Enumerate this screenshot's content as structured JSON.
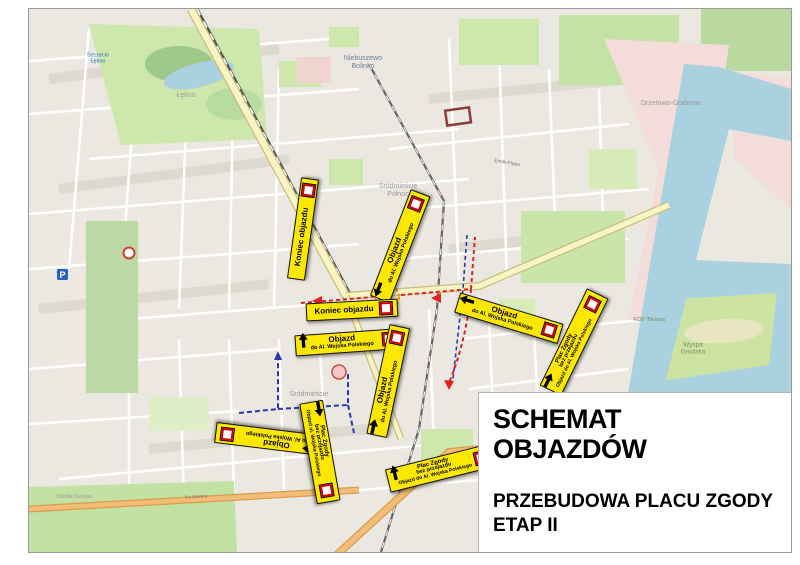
{
  "title_box": {
    "title": "SCHEMAT OBJAZDÓW",
    "subtitle_line1": "PRZEBUDOWA PLACU ZGODY",
    "subtitle_line2": "ETAP II"
  },
  "colors": {
    "detour_label_bg": "#ffe800",
    "detour_label_border": "#111111",
    "closed_route_badge_red": "#d40000",
    "detour_route_red": "#e31e24",
    "detour_route_blue": "#2b35b5",
    "roundabout_orange": "#f59300",
    "water": "#a9d1df",
    "park_green": "#cde7ad",
    "district_pink": "#f3dcda",
    "road_yellow": "#f8f4c6",
    "road_orange": "#f4bd77",
    "map_background": "#eceae2"
  },
  "detour_labels": [
    {
      "id": "koniec-objazdu-north",
      "x": 274,
      "y": 220,
      "rot": -82,
      "w": 90,
      "items": [
        {
          "t": "text",
          "lines": [
            "Koniec objazdu"
          ],
          "sizes": [
            8
          ]
        },
        {
          "t": "badge"
        }
      ]
    },
    {
      "id": "objazd-north",
      "x": 371,
      "y": 237,
      "rot": -69,
      "w": 102,
      "items": [
        {
          "t": "arrow",
          "dir": "left"
        },
        {
          "t": "text",
          "lines": [
            "Objazd",
            "do Al. Wojska Polskiego"
          ],
          "sizes": [
            8,
            5.5
          ]
        },
        {
          "t": "badge"
        }
      ]
    },
    {
      "id": "koniec-objazdu-center",
      "x": 323,
      "y": 301,
      "rot": -3,
      "w": 80,
      "items": [
        {
          "t": "text",
          "lines": [
            "Koniec objazdu"
          ],
          "sizes": [
            8
          ]
        },
        {
          "t": "badge"
        }
      ]
    },
    {
      "id": "objazd-center-horizontal",
      "x": 319,
      "y": 333,
      "rot": -4,
      "w": 94,
      "items": [
        {
          "t": "arrow",
          "dir": "up"
        },
        {
          "t": "text",
          "lines": [
            "Objazd",
            "do Al. Wojska Polskiego"
          ],
          "sizes": [
            8,
            5.5
          ]
        },
        {
          "t": "badge"
        }
      ]
    },
    {
      "id": "objazd-center-vertical",
      "x": 359,
      "y": 372,
      "rot": -78,
      "w": 100,
      "items": [
        {
          "t": "text",
          "lines": [
            "Objazd",
            "do Al. Wojska Polskiego"
          ],
          "sizes": [
            8,
            5.5
          ]
        },
        {
          "t": "arrow",
          "dir": "right"
        },
        {
          "t": "badge"
        }
      ]
    },
    {
      "id": "objazd-east",
      "x": 480,
      "y": 309,
      "rot": 17,
      "w": 96,
      "items": [
        {
          "t": "arrow",
          "dir": "left"
        },
        {
          "t": "text",
          "lines": [
            "Objazd",
            "do Al. Wojska Polskiego"
          ],
          "sizes": [
            8,
            5.5
          ]
        },
        {
          "t": "badge"
        }
      ]
    },
    {
      "id": "plac-zgody-east",
      "x": 545,
      "y": 333,
      "rot": -64,
      "w": 96,
      "items": [
        {
          "t": "text",
          "lines": [
            "Plac Zgody",
            "bez przejazdu",
            "Objazd do Al. Wojska Polskiego"
          ],
          "sizes": [
            6,
            5.5,
            5
          ]
        },
        {
          "t": "arrow",
          "dir": "right"
        },
        {
          "t": "badge"
        }
      ]
    },
    {
      "id": "objazd-southwest",
      "x": 238,
      "y": 430,
      "rot": 187,
      "w": 92,
      "items": [
        {
          "t": "text",
          "lines": [
            "Objazd",
            "do Al. Wojska Polskiego"
          ],
          "sizes": [
            8,
            5.5
          ]
        },
        {
          "t": "arrow",
          "dir": "right"
        },
        {
          "t": "badge"
        }
      ]
    },
    {
      "id": "plac-zgody-southwest",
      "x": 291,
      "y": 443,
      "rot": 80,
      "w": 90,
      "items": [
        {
          "t": "text",
          "lines": [
            "Plac Zgody",
            "bez przejazdu",
            "Objazd ul. Wojska Polskiego"
          ],
          "sizes": [
            6,
            5.5,
            5
          ]
        },
        {
          "t": "arrow",
          "dir": "right"
        },
        {
          "t": "badge"
        }
      ]
    },
    {
      "id": "plac-zgody-south",
      "x": 411,
      "y": 459,
      "rot": -14,
      "w": 88,
      "items": [
        {
          "t": "arrow",
          "dir": "up"
        },
        {
          "t": "text",
          "lines": [
            "Plac Zgody",
            "bez przejazdu",
            "Objazd do Al. Wojska Polskiego"
          ],
          "sizes": [
            6,
            5.5,
            5
          ]
        },
        {
          "t": "badge"
        }
      ]
    }
  ],
  "map_labels": [
    {
      "id": "district-niebuszewo-bolinko",
      "lines": [
        "Niebuszewo",
        "Bolinko"
      ],
      "x": 334,
      "y": 54,
      "size": 7,
      "color": "#6f7f96",
      "rot": 0
    },
    {
      "id": "district-srodmiescie-polnoc",
      "lines": [
        "Śródmieście",
        "Północ"
      ],
      "x": 369,
      "y": 182,
      "size": 7,
      "color": "#9a9a9a",
      "rot": 0
    },
    {
      "id": "district-srodmiescie",
      "lines": [
        "Śródmieście"
      ],
      "x": 280,
      "y": 386,
      "size": 7,
      "color": "#9a9a9a",
      "rot": 0
    },
    {
      "id": "district-lekno",
      "lines": [
        "Łękno"
      ],
      "x": 157,
      "y": 87,
      "size": 7,
      "color": "#9a9a9a",
      "rot": 0
    },
    {
      "id": "district-drzetowo-grabowo",
      "lines": [
        "Drzetowo-Grabowo"
      ],
      "x": 642,
      "y": 95,
      "size": 7,
      "color": "#9a9a9a",
      "rot": 0
    },
    {
      "id": "island-wyspa-grodzka",
      "lines": [
        "Wyspa",
        "Grodzka"
      ],
      "x": 664,
      "y": 340,
      "size": 6.5,
      "color": "#7d8d62",
      "rot": 0
    },
    {
      "id": "area-rod-bielawa",
      "lines": [
        "ROD \"Bielawa\""
      ],
      "x": 621,
      "y": 312,
      "size": 5,
      "color": "#7d8d62",
      "rot": 0
    },
    {
      "id": "district-osiedle-zacheta",
      "lines": [
        "Osiedle Zachęta"
      ],
      "x": 45,
      "y": 489,
      "size": 5,
      "color": "#999999",
      "rot": 0
    },
    {
      "id": "station-szczecin-lekno",
      "lines": [
        "Szczecin",
        "Łękno"
      ],
      "x": 69,
      "y": 50,
      "size": 5.5,
      "color": "#1a6fc4",
      "rot": 0
    },
    {
      "id": "street-ku-sloncu",
      "lines": [
        "Ku Słońcu"
      ],
      "x": 167,
      "y": 489,
      "size": 5,
      "color": "#777777",
      "rot": -3
    },
    {
      "id": "street-emilii-plater",
      "lines": [
        "Emilii Plater"
      ],
      "x": 478,
      "y": 155,
      "size": 5,
      "color": "#777777",
      "rot": 10
    }
  ]
}
